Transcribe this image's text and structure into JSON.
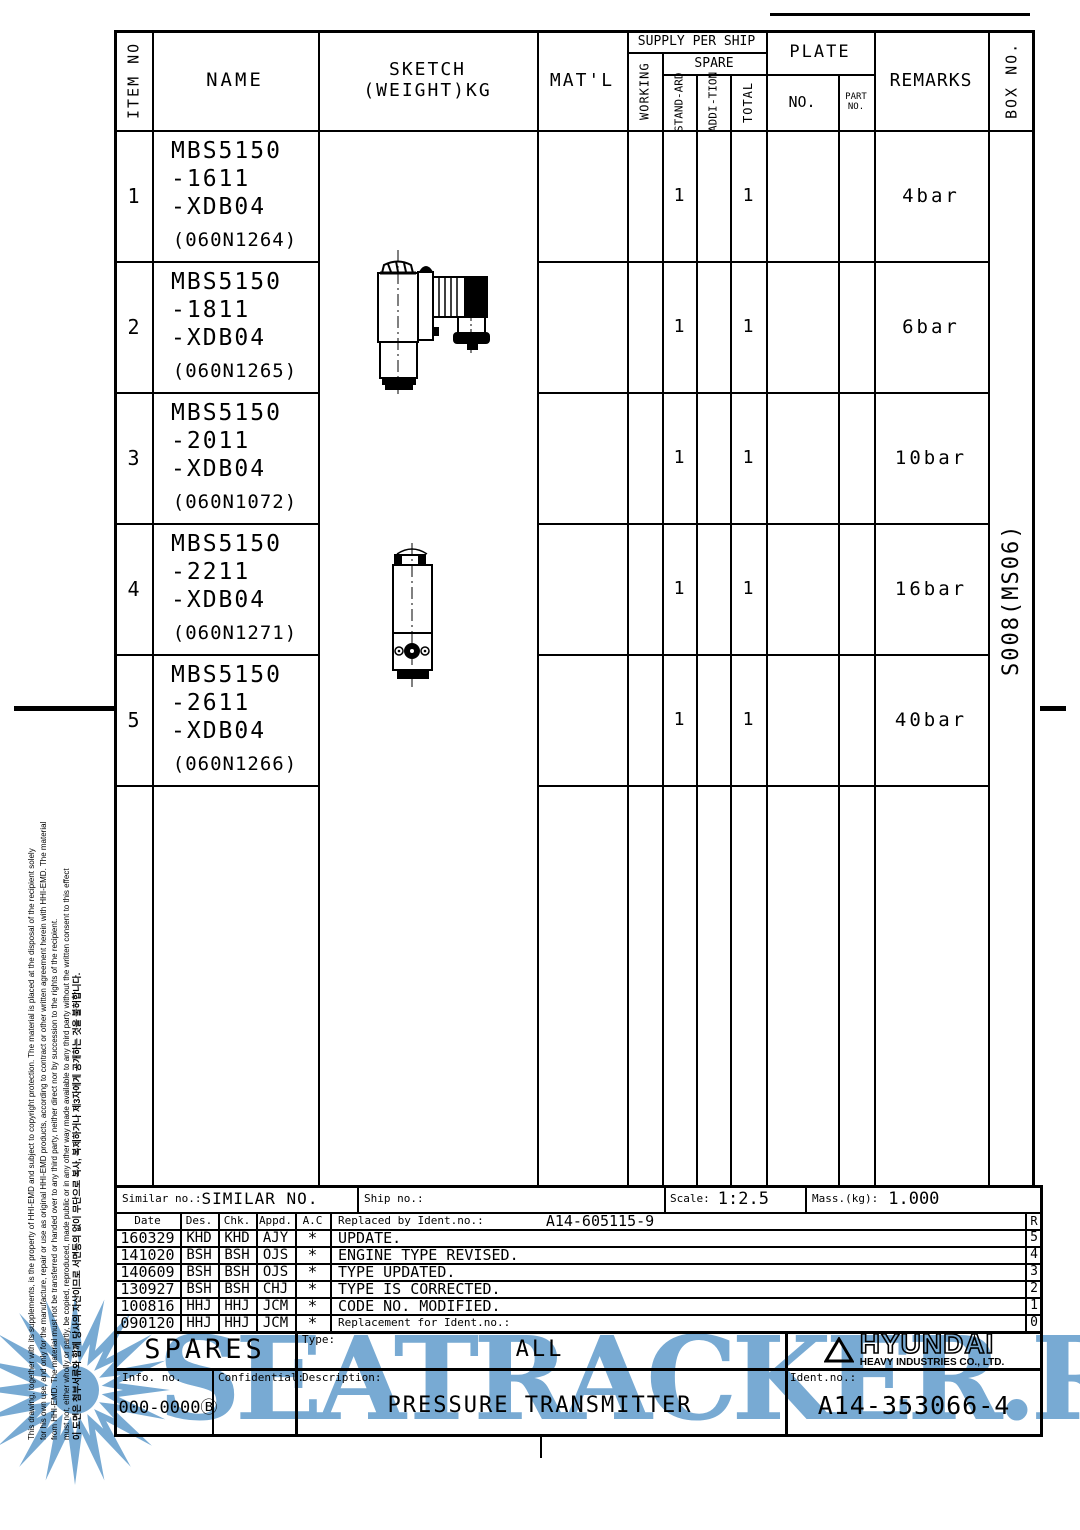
{
  "table": {
    "headers": {
      "item_no": "ITEM NO",
      "name": "NAME",
      "sketch": "SKETCH",
      "sketch_sub": "(WEIGHT)KG",
      "matl": "MAT'L",
      "supply_per_ship": "SUPPLY PER SHIP",
      "working": "WORKING",
      "spare": "SPARE",
      "standard_1": "STAND",
      "standard_2": "-ARD",
      "addition_1": "ADDI",
      "addition_2": "-TION",
      "total": "TOTAL",
      "plate": "PLATE",
      "plate_no": "NO.",
      "part_no_1": "PART",
      "part_no_2": "NO.",
      "remarks": "REMARKS",
      "box_no": "BOX NO."
    },
    "rows": [
      {
        "item": "1",
        "l1": "MBS5150",
        "l2": "-1611",
        "l3": "-XDB04",
        "code": "(060N1264)",
        "standard": "1",
        "total": "1",
        "remarks": "4bar"
      },
      {
        "item": "2",
        "l1": "MBS5150",
        "l2": "-1811",
        "l3": "-XDB04",
        "code": "(060N1265)",
        "standard": "1",
        "total": "1",
        "remarks": "6bar"
      },
      {
        "item": "3",
        "l1": "MBS5150",
        "l2": "-2011",
        "l3": "-XDB04",
        "code": "(060N1072)",
        "standard": "1",
        "total": "1",
        "remarks": "10bar"
      },
      {
        "item": "4",
        "l1": "MBS5150",
        "l2": "-2211",
        "l3": "-XDB04",
        "code": "(060N1271)",
        "standard": "1",
        "total": "1",
        "remarks": "16bar"
      },
      {
        "item": "5",
        "l1": "MBS5150",
        "l2": "-2611",
        "l3": "-XDB04",
        "code": "(060N1266)",
        "standard": "1",
        "total": "1",
        "remarks": "40bar"
      }
    ],
    "box_no_value": "S008(MS06)"
  },
  "similar": {
    "similar_label": "Similar no.:",
    "similar_value": "SIMILAR NO.",
    "ship_label": "Ship no.:",
    "scale_label": "Scale:",
    "scale_value": "1:2.5",
    "mass_label": "Mass.(kg):",
    "mass_value": "1.000"
  },
  "revision": {
    "date": "Date",
    "des": "Des.",
    "chk": "Chk.",
    "appd": "Appd.",
    "ac": "A.C",
    "replaced_label": "Replaced by Ident.no.:",
    "replaced_value": "A14-605115-9",
    "r": "R",
    "rows": [
      {
        "date": "160329",
        "des": "KHD",
        "chk": "KHD",
        "appd": "AJY",
        "ac": "*",
        "desc": "UPDATE.",
        "rev": "5"
      },
      {
        "date": "141020",
        "des": "BSH",
        "chk": "BSH",
        "appd": "OJS",
        "ac": "*",
        "desc": "ENGINE TYPE REVISED.",
        "rev": "4"
      },
      {
        "date": "140609",
        "des": "BSH",
        "chk": "BSH",
        "appd": "OJS",
        "ac": "*",
        "desc": "TYPE UPDATED.",
        "rev": "3"
      },
      {
        "date": "130927",
        "des": "BSH",
        "chk": "BSH",
        "appd": "CHJ",
        "ac": "*",
        "desc": "TYPE IS CORRECTED.",
        "rev": "2"
      },
      {
        "date": "100816",
        "des": "HHJ",
        "chk": "HHJ",
        "appd": "JCM",
        "ac": "*",
        "desc": "CODE NO. MODIFIED.",
        "rev": "1"
      },
      {
        "date": "090120",
        "des": "HHJ",
        "chk": "HHJ",
        "appd": "JCM",
        "ac": "*",
        "desc": "Replacement for Ident.no.:",
        "rev": "0"
      }
    ]
  },
  "title_block": {
    "spares": "SPARES",
    "type_label": "Type:",
    "type_value": "ALL",
    "info_label": "Info. no.",
    "info_value": "000-0000Ⓑ",
    "confidential_label": "Confidential:",
    "description_label": "Description:",
    "description_value": "PRESSURE TRANSMITTER",
    "ident_label": "Ident.no.:",
    "ident_value": "A14-353066-4",
    "brand": "HYUNDAI",
    "brand_sub": "HEAVY INDUSTRIES CO., LTD."
  },
  "disclaimer_lines": [
    "This drawing, together with its supplements, is the property of HHI-EMD and subject to copyright protection. The material is placed at the disposal of the recipient solely",
    "for his own use, and only for the manufacture, repair or use as original HHI-EMD products, according to contract or other written agreement herein with HHI-EMD. The material",
    "from HHI-EMD. The material must not be transferred or handed over to any third party, neither direct nor by succession to the rights of the recipient.",
    "must not, either wholly or partly, be copied, reproduced, made public or in any other way made available to any third party without the written consent to this effect",
    "이 도면은 첨부서류와 함께 당사의 자산이므로 서면동의 없이 무단으로 복사, 복제하거나 제3자에게 공개하는 것을 불허합니다."
  ],
  "watermark": {
    "text": "SEATRACKER.RU",
    "color": "#6CA3CF"
  }
}
